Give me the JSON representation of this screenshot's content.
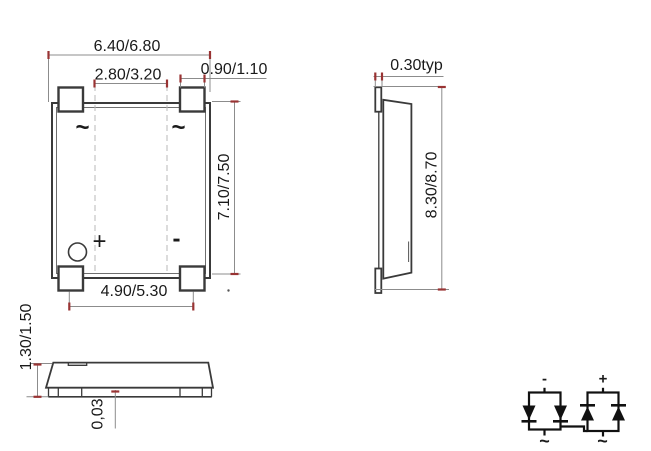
{
  "colors": {
    "background": "#ffffff",
    "outline": "#3a3a3a",
    "dimension_line": "#8c8c8c",
    "dimension_tick": "#993333",
    "text": "#1a1a1a",
    "centerline_dash": "#b8b8b8",
    "schematic_line": "#111111"
  },
  "front": {
    "dim_width": "6.40/6.80",
    "dim_terminal_pitch": "2.80/3.20",
    "dim_terminal_width": "0.90/1.10",
    "dim_height": "7.10/7.50",
    "dim_terminal_span": "4.90/5.30",
    "marking_ac_left": "~",
    "marking_ac_right": "~",
    "marking_plus": "+",
    "marking_minus": "-"
  },
  "side": {
    "dim_lead_thickness": "0.30typ",
    "dim_overall_height": "8.30/8.70"
  },
  "profile": {
    "dim_body_thickness": "1.30/1.50",
    "dim_standoff": "0,03"
  },
  "schematic": {
    "terminal_minus": "-",
    "terminal_plus": "+",
    "terminal_ac_left": "~",
    "terminal_ac_right": "~"
  }
}
